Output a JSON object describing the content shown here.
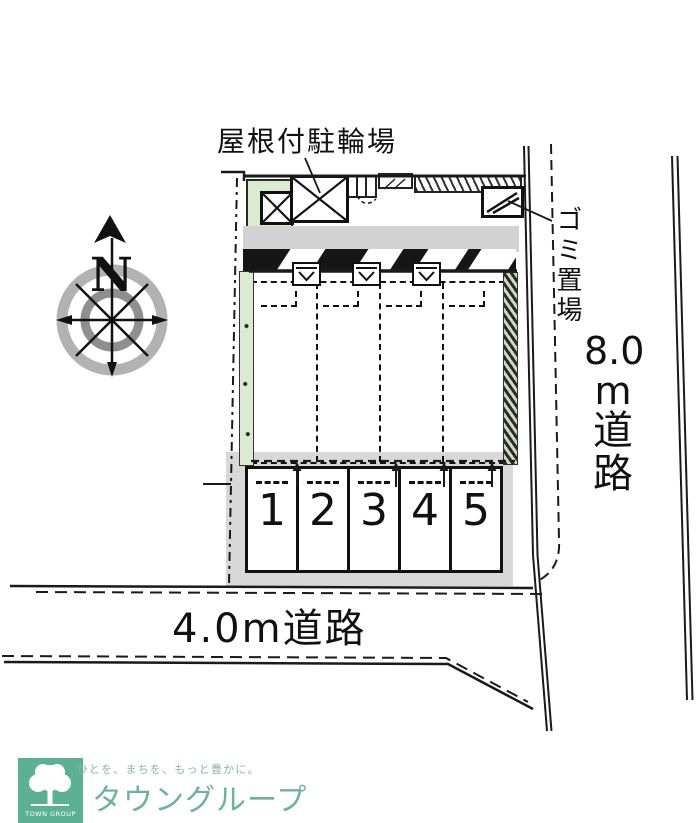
{
  "plan": {
    "labels": {
      "bicycle_parking": "屋根付駐輪場",
      "garbage": "ゴミ置場",
      "road_east_full": "8.0m道路",
      "road_east_parts": {
        "size": "8.0",
        "unit": "m",
        "kanji1": "道",
        "kanji2": "路"
      },
      "road_south": "4.0m道路",
      "compass_north": "N"
    },
    "parking": {
      "stalls": [
        "1",
        "2",
        "3",
        "4",
        "5"
      ]
    }
  },
  "logo": {
    "tagline": "ひとを、まちを、もっと豊かに。",
    "brand": "タウングループ",
    "caption": "TOWN GROUP"
  },
  "colors": {
    "line": "#1a1a1a",
    "approach_band": "#d2d2d2",
    "building_band": "#161616",
    "parking_surround": "#d8d8d8",
    "planting_green": "#dcead2",
    "logo_green": "#5cb094",
    "brand_text": "#6cb39c",
    "tagline_text": "#8fb3a6"
  }
}
